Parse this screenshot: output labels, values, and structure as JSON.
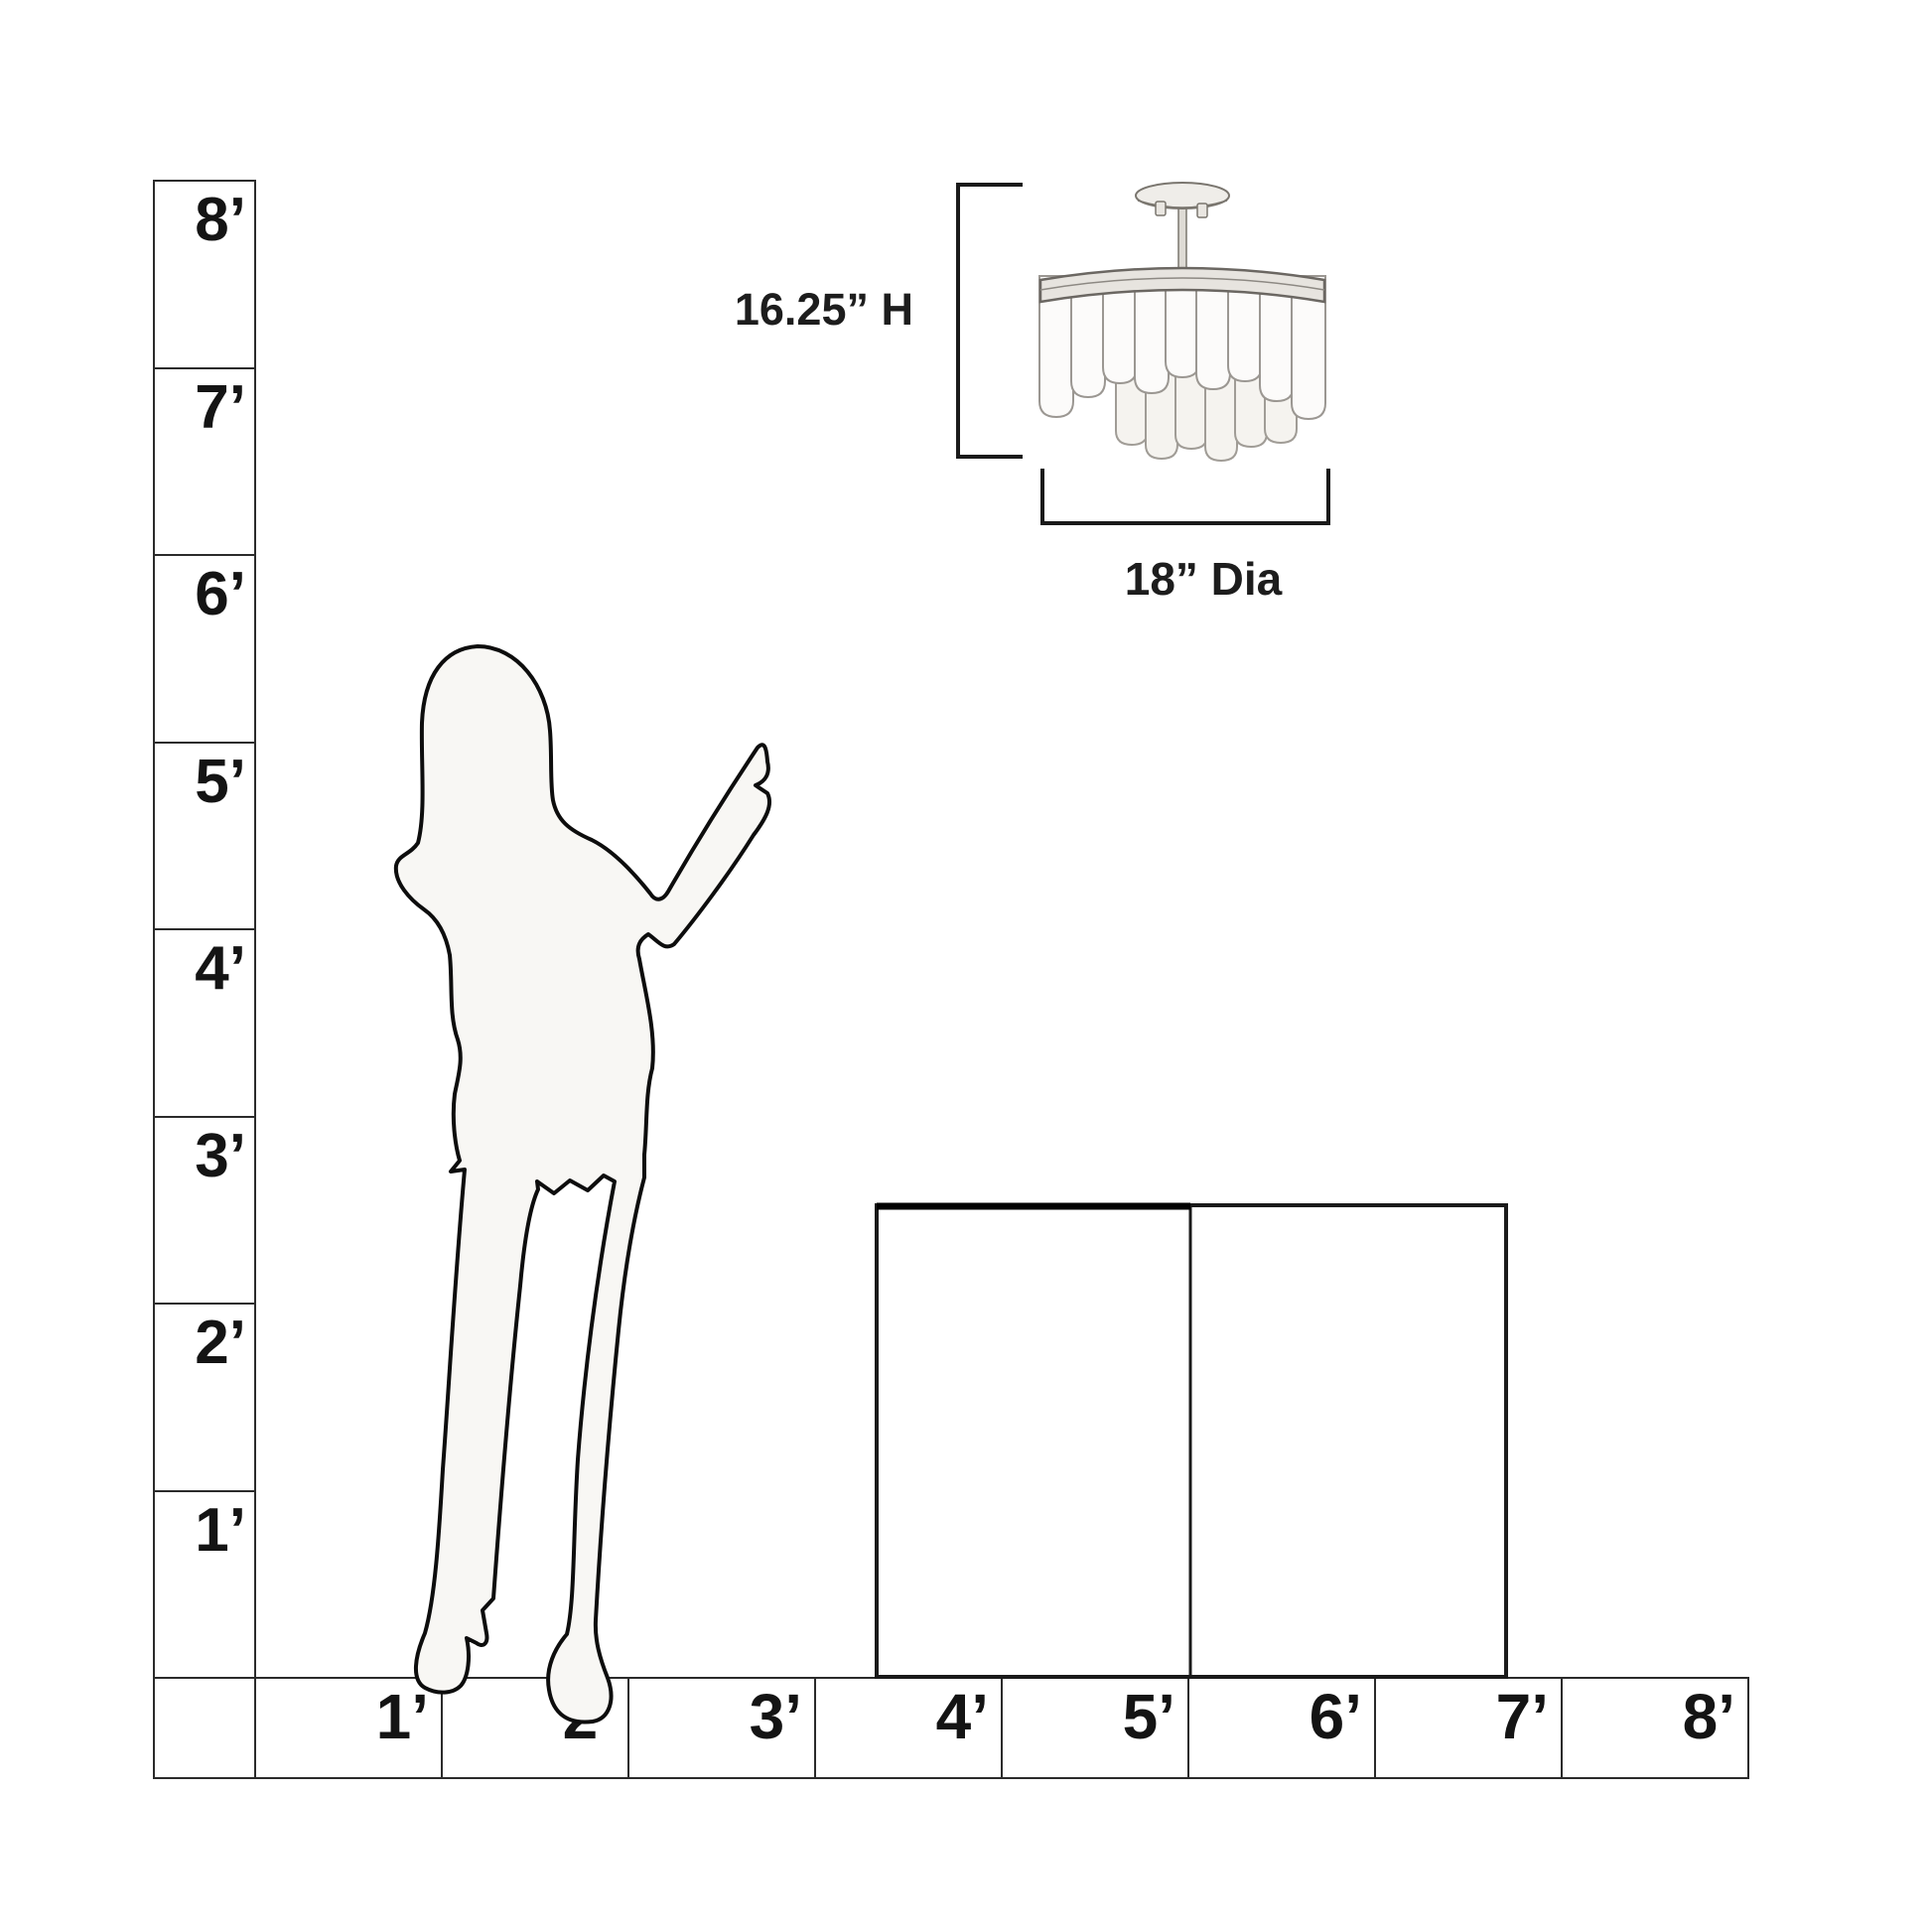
{
  "title": "Product size guide scale diagram",
  "colors": {
    "background": "#ffffff",
    "line": "#1c1c1c",
    "silhouette_fill": "#f8f7f4",
    "fixture_band_fill": "#e7e4df",
    "feather_fill": "#fcfbfa"
  },
  "fixture": {
    "height_label": "16.25” H",
    "diameter_label": "18” Dia"
  },
  "vertical_ruler": {
    "labels": [
      "8’",
      "7’",
      "6’",
      "5’",
      "4’",
      "3’",
      "2’",
      "1’"
    ]
  },
  "horizontal_ruler": {
    "corner_label": "",
    "labels": [
      "1’",
      "2’",
      "3’",
      "4’",
      "5’",
      "6’",
      "7’",
      "8’"
    ]
  }
}
